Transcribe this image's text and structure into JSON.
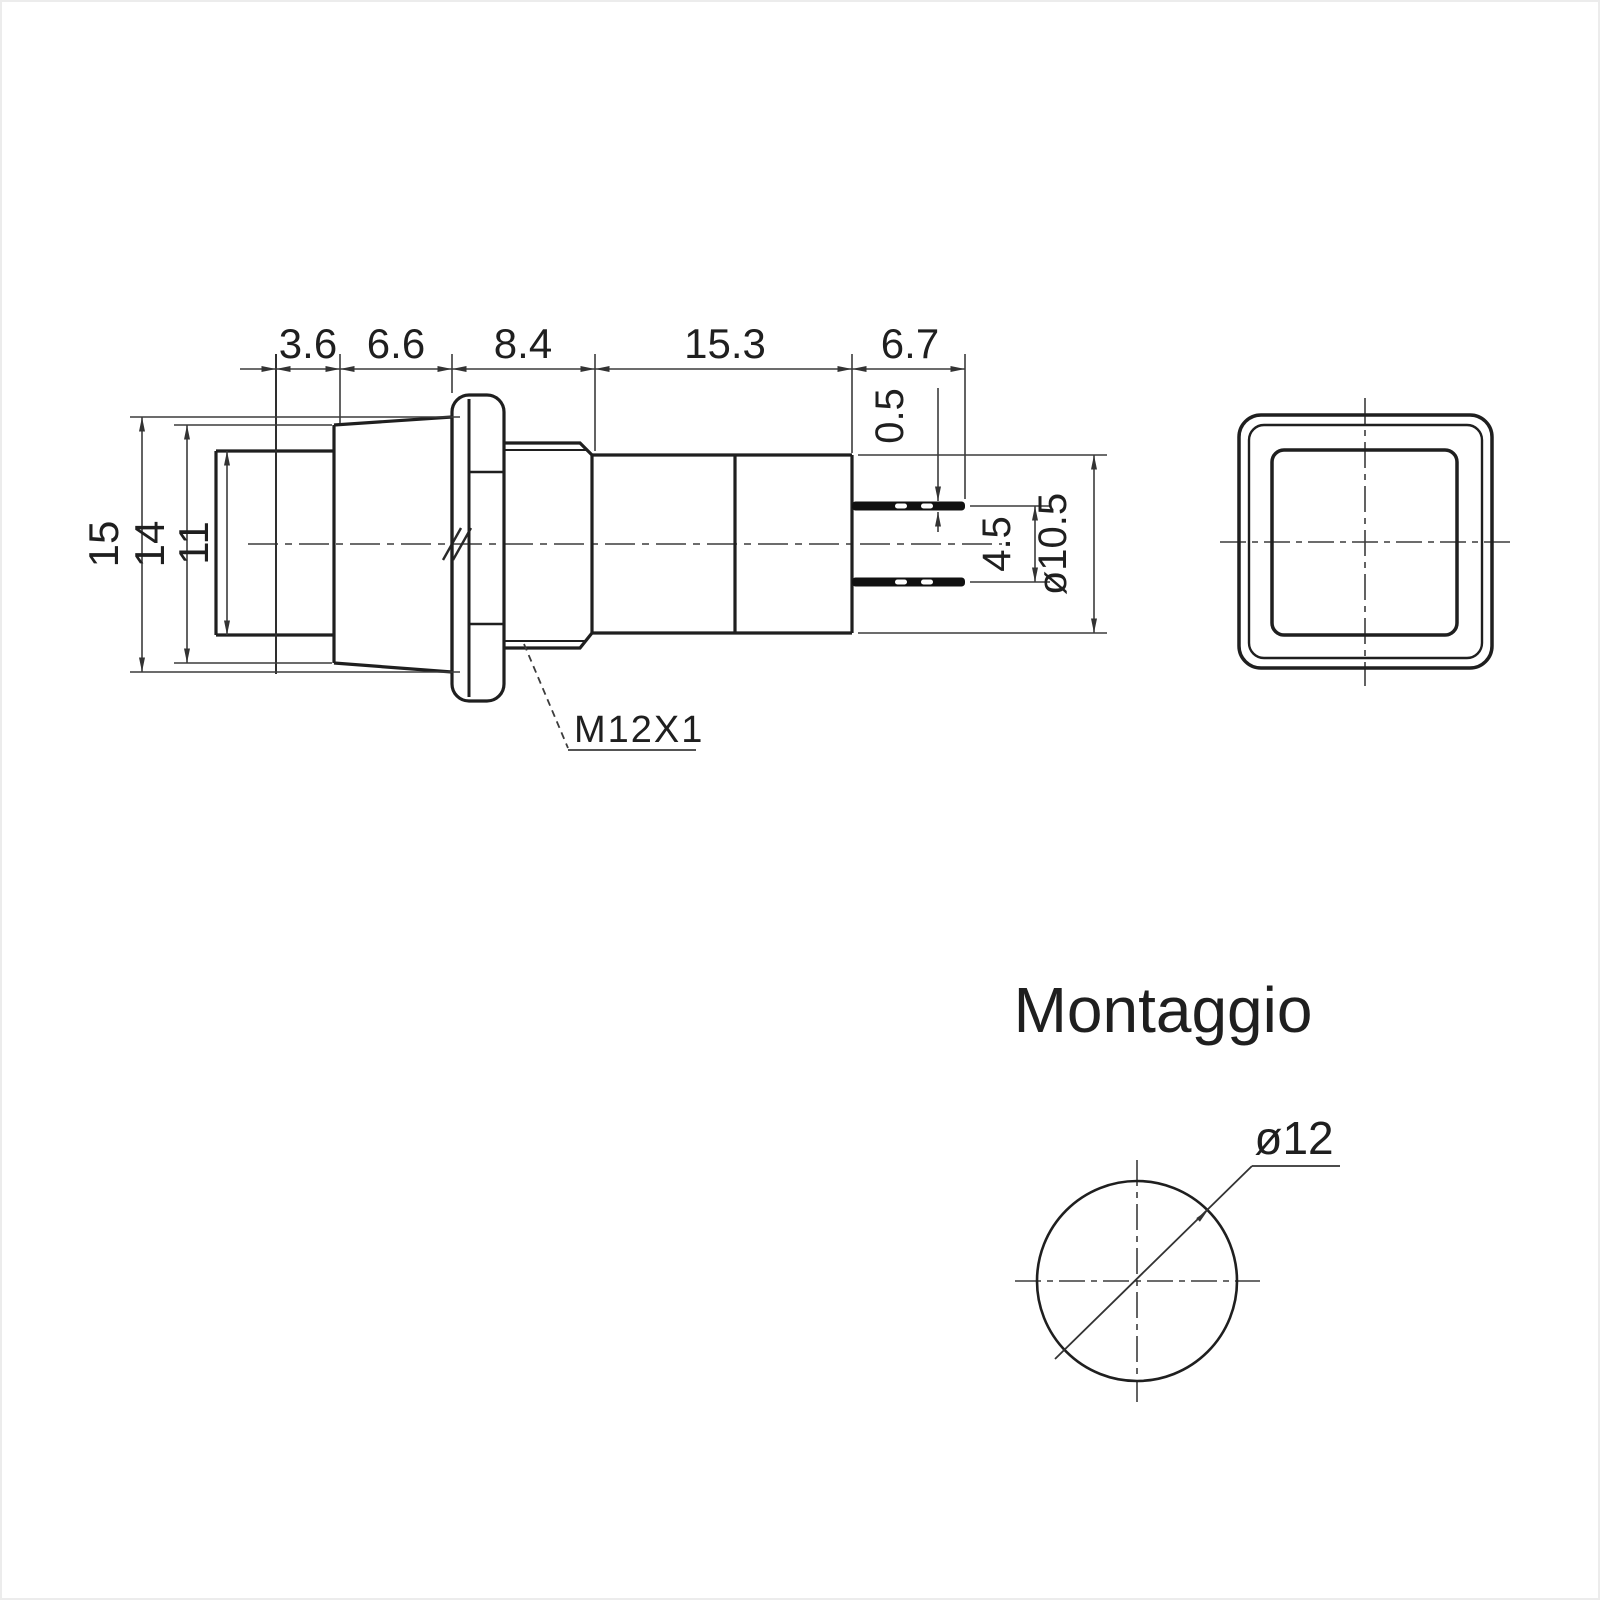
{
  "title": "Pulsante quadrato - disegno tecnico quotato",
  "colors": {
    "background": "#ffffff",
    "part_line": "#1f1f1f",
    "dim_line": "#3c3c3c",
    "terminal_fill": "#111111"
  },
  "side_view": {
    "top_dimensions": [
      "3.6",
      "6.6",
      "8.4",
      "15.3",
      "6.7"
    ],
    "height_dimensions": [
      "15",
      "14",
      "11"
    ],
    "terminal_thickness": "0.5",
    "terminal_spacing": "4.5",
    "body_diameter": "ø10.5",
    "thread_spec": "M12X1"
  },
  "mounting": {
    "title": "Montaggio",
    "hole_diameter": "ø12"
  }
}
